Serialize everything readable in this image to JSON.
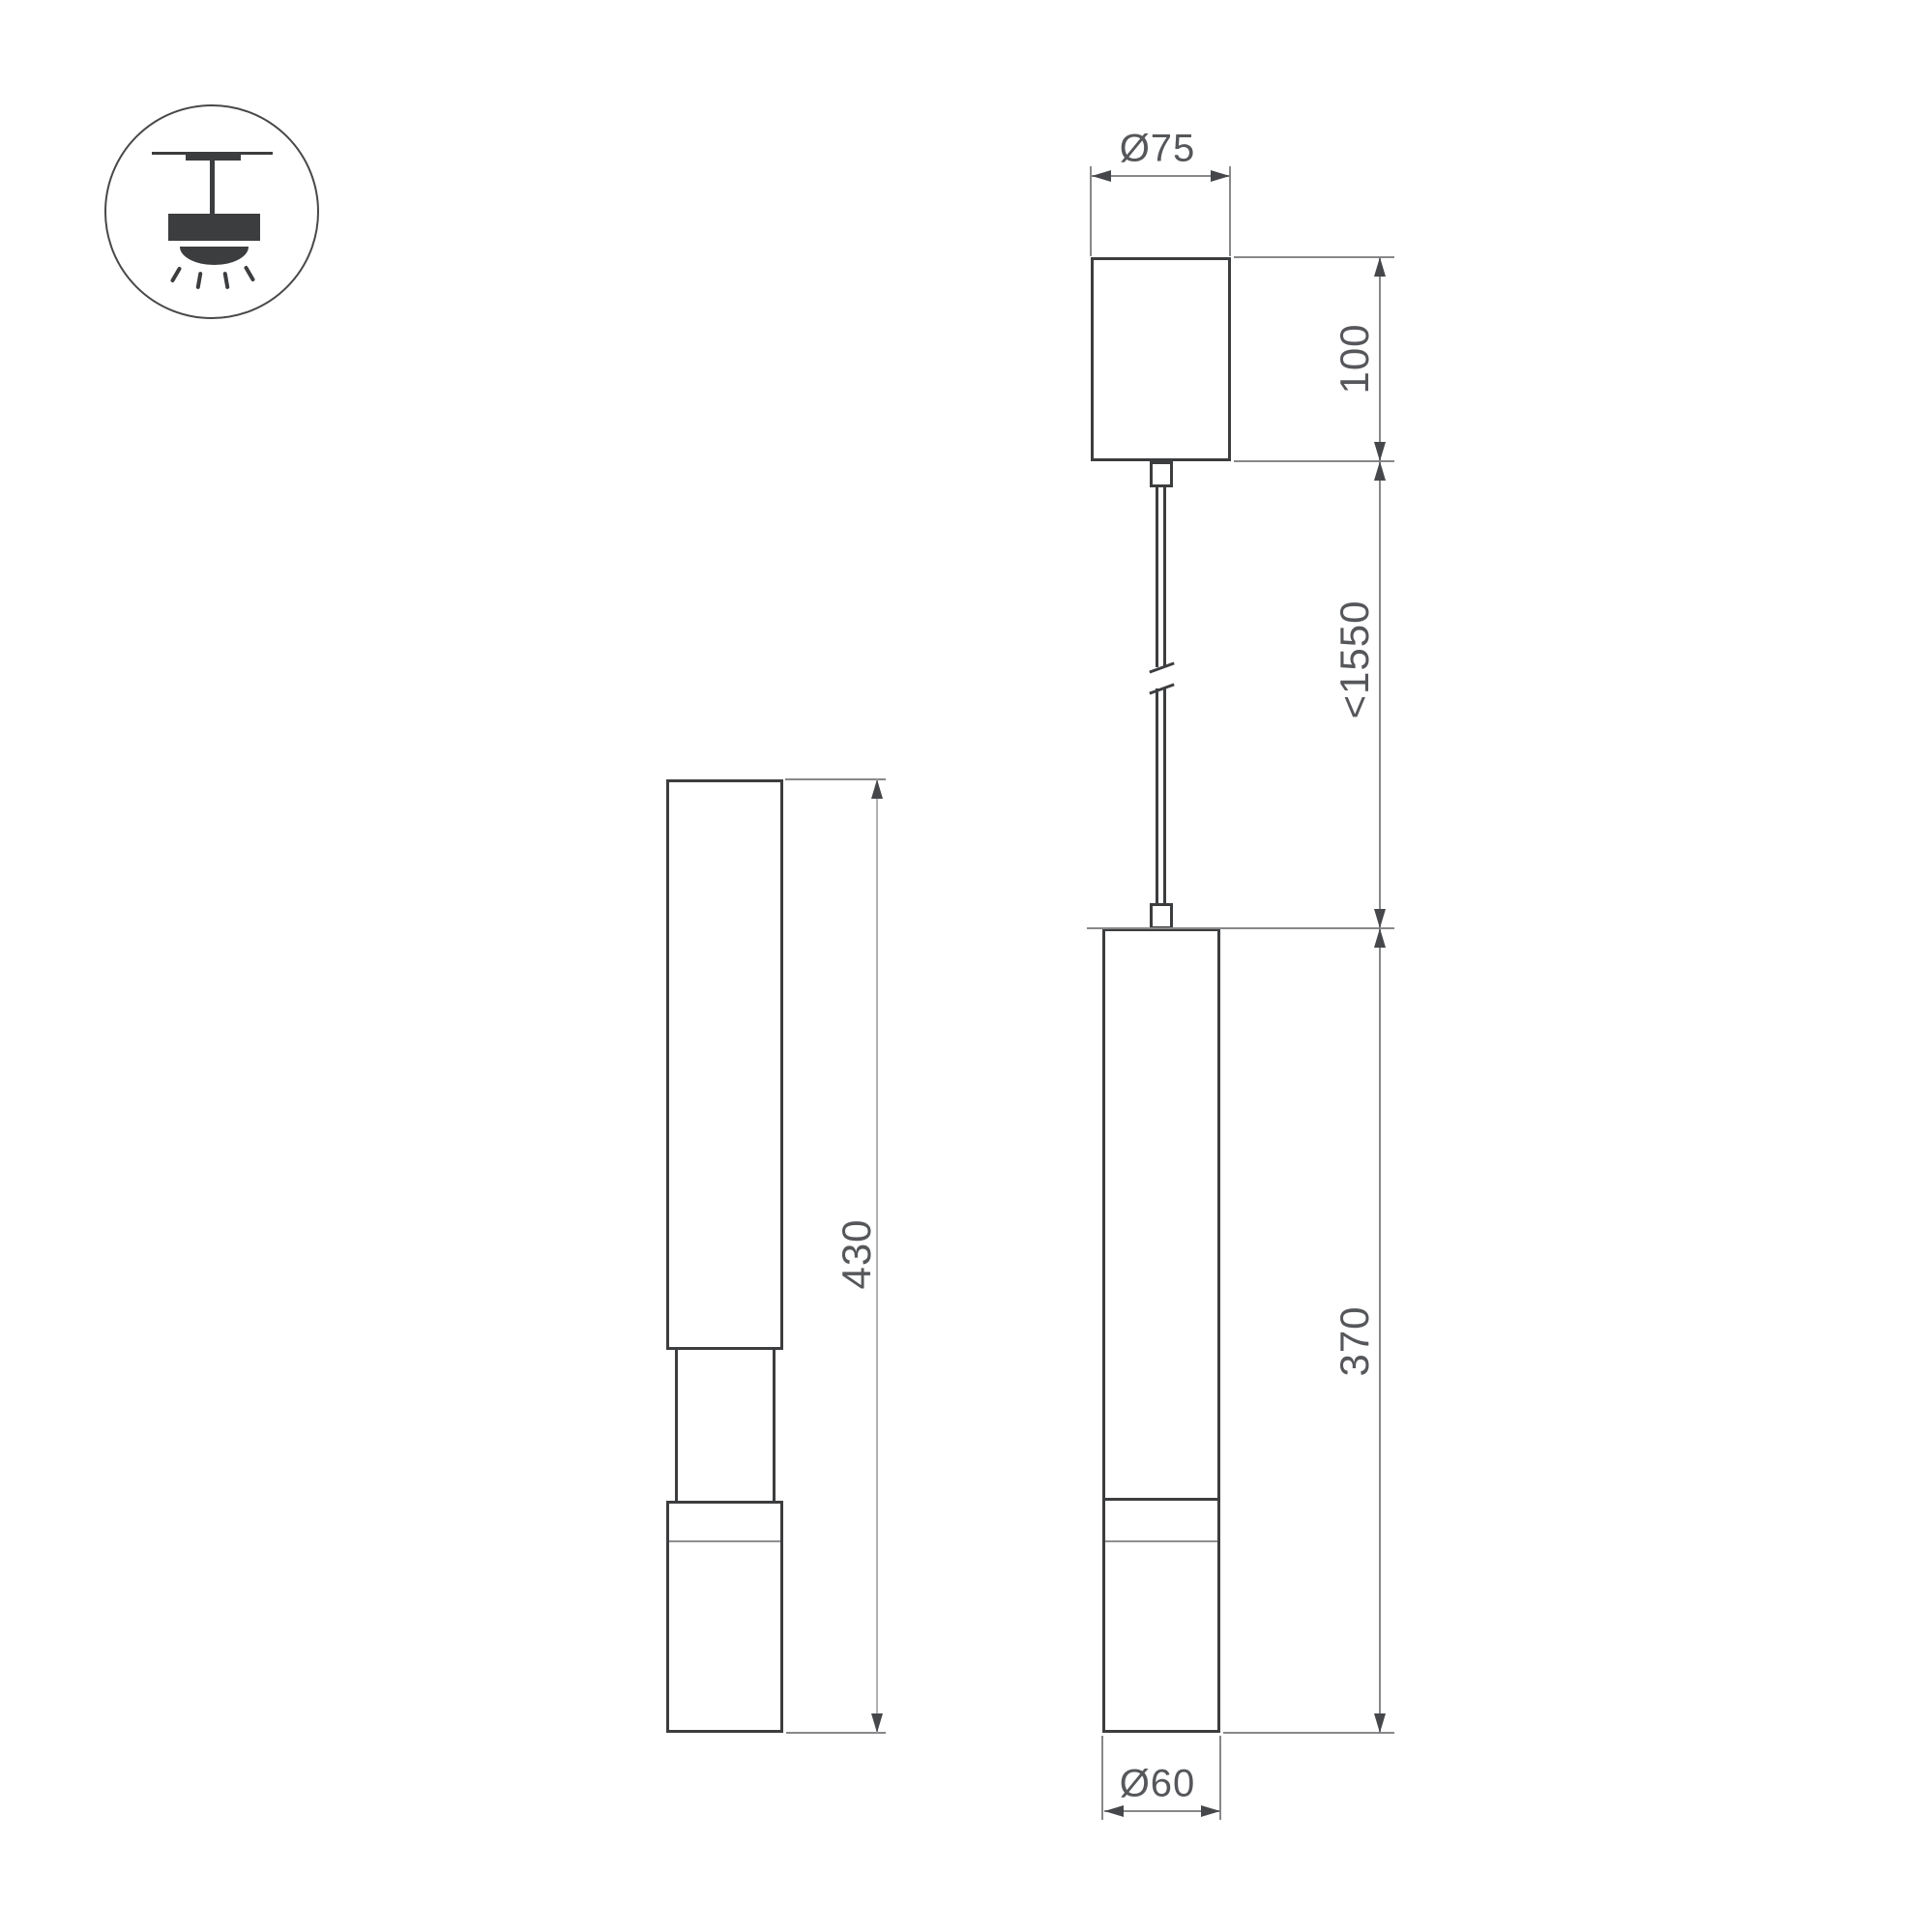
{
  "drawing": {
    "title": "pendant-luminaire-dimension-drawing",
    "labels": {
      "canopy_diameter": "Ø75",
      "canopy_height": "100",
      "max_suspension": "<1550",
      "body_height": "370",
      "body_diameter": "Ø60",
      "side_view_height": "430"
    },
    "icon": "ceiling-pendant-light",
    "colors": {
      "outline": "#3c3d3f",
      "dimension_line": "#87888a",
      "light_dimension_line": "#b0b1b3",
      "arrow": "#46474a",
      "text": "#55575a",
      "background": "#ffffff"
    }
  }
}
